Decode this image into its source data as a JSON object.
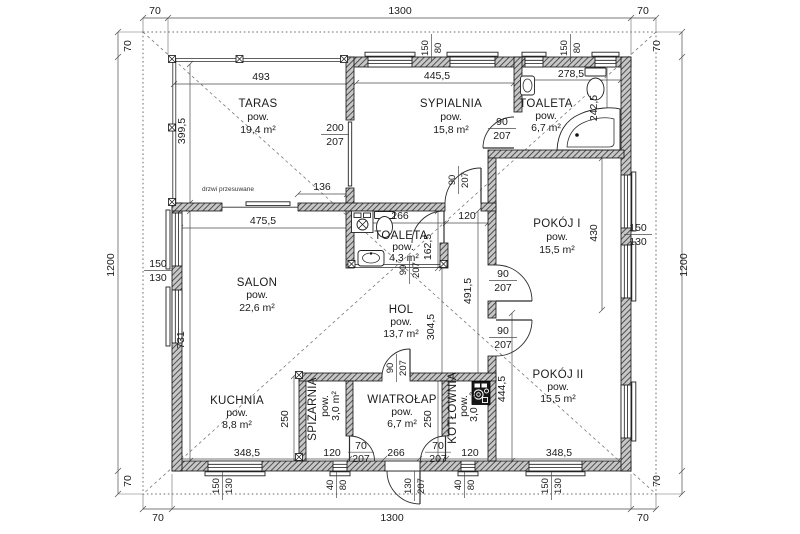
{
  "rooms": {
    "taras": {
      "name": "TARAS",
      "pow_label": "pow.",
      "area": "19,4 m²"
    },
    "sypialnia": {
      "name": "SYPIALNIA",
      "pow_label": "pow.",
      "area": "15,8 m²"
    },
    "toaleta_gorna": {
      "name": "TOALETA",
      "pow_label": "pow.",
      "area": "6,7 m²"
    },
    "pokoj_1": {
      "name": "POKÓJ I",
      "pow_label": "pow.",
      "area": "15,5 m²"
    },
    "salon": {
      "name": "SALON",
      "pow_label": "pow.",
      "area": "22,6 m²"
    },
    "toaleta_mala": {
      "name": "TOALETA",
      "pow_label": "pow.",
      "area": "4,3 m²"
    },
    "hol": {
      "name": "HOL",
      "pow_label": "pow.",
      "area": "13,7 m²"
    },
    "kuchnia": {
      "name": "KUCHNIA",
      "pow_label": "pow.",
      "area": "8,8 m²"
    },
    "spizarnia": {
      "name": "SPIŻARNIA",
      "pow_label": "pow.",
      "area": "3,0 m²"
    },
    "wiatrolap": {
      "name": "WIATROŁAP",
      "pow_label": "pow.",
      "area": "6,7 m²"
    },
    "kotlownia": {
      "name": "KOTŁOWNIA",
      "pow_label": "pow.",
      "area": "3,0 m²"
    },
    "pokoj_2": {
      "name": "POKÓJ II",
      "pow_label": "pow.",
      "area": "15,5 m²"
    }
  },
  "outer_dims": {
    "top_left": "70",
    "top_center": "1300",
    "top_right": "70",
    "bottom_left": "70",
    "bottom_center": "1300",
    "bottom_right": "70",
    "left_top": "70",
    "left_center": "1200",
    "left_bottom": "70",
    "right_top": "70",
    "right_center": "1200",
    "right_bottom": "70"
  },
  "dims": {
    "taras_width": "493",
    "taras_height": "399,5",
    "taras_opening": "136",
    "taras_door_w": "200",
    "taras_door_h": "207",
    "sypialnia_width": "445,5",
    "toaleta_g_width": "278,5",
    "toaleta_g_height": "242,5",
    "window_top_1_w": "150",
    "window_top_1_h": "80",
    "window_top_2_w": "150",
    "window_top_2_h": "80",
    "door_syp_toaleta_w": "90",
    "door_syp_toaleta_h": "207",
    "door_syp_hol_w": "90",
    "door_syp_hol_h": "207",
    "salon_width": "475,5",
    "salon_height": "731",
    "window_left_w": "150",
    "window_left_h": "130",
    "toaleta_m_width": "266",
    "toaleta_m_height": "162,5",
    "door_toaleta_m_w": "90",
    "door_toaleta_m_h": "207",
    "hol_top_width": "120",
    "hol_height": "304,5",
    "hol_right_height": "491,5",
    "pokoj1_height": "430",
    "window_right_w": "150",
    "window_right_h": "130",
    "door_pokoj1_w": "90",
    "door_pokoj1_h": "207",
    "door_pokoj2_w": "90",
    "door_pokoj2_h": "207",
    "pokoj2_height": "444,5",
    "pokoj2_width": "348,5",
    "kuchnia_width": "348,5",
    "kuchnia_height": "250",
    "spizarnia_width": "120",
    "door_spizarnia_w": "70",
    "door_spizarnia_h": "207",
    "wiatrolap_width": "266",
    "wiatrolap_height": "250",
    "door_wiatrolap_w": "90",
    "door_wiatrolap_h": "207",
    "kotlownia_width": "120",
    "door_kotlownia_w": "70",
    "door_kotlownia_h": "207",
    "entrance_door_w": "130",
    "entrance_door_h": "207",
    "window_b_kuchnia_w": "150",
    "window_b_kuchnia_h": "130",
    "window_b_spizarnia_w": "40",
    "window_b_spizarnia_h": "80",
    "window_b_kotlownia_w": "40",
    "window_b_kotlownia_h": "80",
    "window_b_pokoj2_w": "150",
    "window_b_pokoj2_h": "130"
  },
  "annotations": {
    "sliding_door": "drzwi przesuwane"
  },
  "fixtures": {
    "corner_bathtub": "corner-bathtub",
    "toilet_top": "toilet",
    "toilet_center": "toilet",
    "washbasin_top": "washbasin",
    "washbasin_center": "washbasin",
    "washing_machine": "washing-machine",
    "boiler": "boiler-stove"
  },
  "colors": {
    "wall": "#111111",
    "dim_line": "#4c4c4c",
    "text": "#1b1b1b",
    "roof_dash": "#6e6e6e",
    "background": "#ffffff"
  }
}
